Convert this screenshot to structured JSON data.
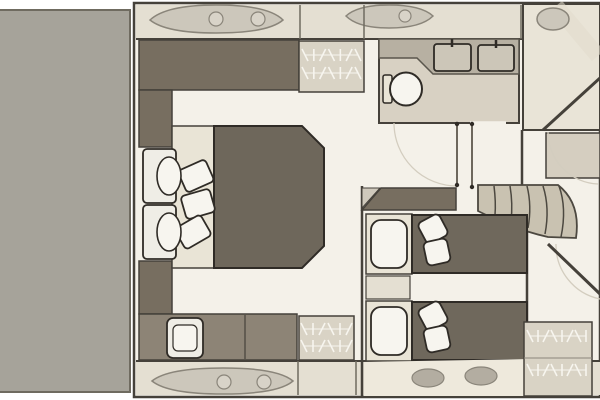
{
  "canvas": {
    "width": 600,
    "height": 400,
    "background": "#ffffff"
  },
  "palette": {
    "garage": "#a6a39a",
    "garageEdge": "#6f6b60",
    "floor": "#f4f1e9",
    "band": "#e4dfd2",
    "bandLight": "#eee9dc",
    "outline": "#45413a",
    "outlineStrong": "#2f2b26",
    "furnDark": "#776e60",
    "bed": "#6e675b",
    "bedTwin": "#6f685c",
    "sofa": "#8d8476",
    "wardrobe": "#d9d3c5",
    "frame": "#e9e4d6",
    "white": "#f7f5ef",
    "white2": "#efede6",
    "bathFloor": "#d8d1c3",
    "counter": "#b7b0a2",
    "counterEdge": "#5a564d",
    "sink": "#ccc6b8",
    "stairs": "#c9c2b1",
    "stairEdge": "#4c4840",
    "hatch": "#ccc7bb",
    "hatch2": "#d8d3c8",
    "hatchEdge": "#8a857a",
    "oval": "#b3ada1",
    "roomLight": "#e9e4d7",
    "bowCab": "#d5cec0",
    "leaf": "#6d675d",
    "faint": "#d3cdbf",
    "sheen": "#e2dccd",
    "wedge": "#cfc9bc"
  },
  "elements": [
    {
      "name": "garage-block",
      "type": "rect",
      "x": -3,
      "y": 10,
      "w": 133,
      "h": 382,
      "fill": "@garage",
      "stroke": "@garageEdge",
      "sw": 2
    },
    {
      "name": "hull-interior-floor",
      "type": "rect",
      "x": 134,
      "y": 3,
      "w": 466,
      "h": 394,
      "fill": "@floor",
      "stroke": "@outline",
      "sw": 2.5
    },
    {
      "name": "side-deck-band-top",
      "type": "rect",
      "x": 136,
      "y": 5,
      "w": 464,
      "h": 34,
      "fill": "@band"
    },
    {
      "name": "side-deck-band-bottom",
      "type": "rect",
      "x": 136,
      "y": 361,
      "w": 464,
      "h": 34,
      "fill": "@band"
    },
    {
      "name": "wall-top-inner",
      "type": "line",
      "x1": 136,
      "y1": 39,
      "x2": 600,
      "y2": 39,
      "stroke": "@outline",
      "sw": 2
    },
    {
      "name": "wall-bottom-inner",
      "type": "line",
      "x1": 136,
      "y1": 361,
      "x2": 600,
      "y2": 361,
      "stroke": "@outline",
      "sw": 2
    },
    {
      "name": "deck-hatch-top-large",
      "type": "path",
      "d": "M150,20 Q166,5 216,5 Q268,5 283,20 Q268,33 216,33 Q166,33 150,20 Z",
      "fill": "@hatch",
      "stroke": "@hatchEdge",
      "sw": 1.5
    },
    {
      "name": "deck-hatch-top-circle-1",
      "type": "ellipse",
      "cx": 216,
      "cy": 19,
      "rx": 7,
      "ry": 7,
      "fill": "@hatch2",
      "stroke": "@hatchEdge",
      "sw": 1.2
    },
    {
      "name": "deck-hatch-top-circle-2",
      "type": "ellipse",
      "cx": 258,
      "cy": 19,
      "rx": 7,
      "ry": 7,
      "fill": "@hatch2",
      "stroke": "@hatchEdge",
      "sw": 1.2
    },
    {
      "name": "deck-hatch-top-small",
      "type": "path",
      "d": "M346,16 Q358,5 389,5 Q421,5 433,16 Q421,28 389,28 Q358,28 346,16 Z",
      "fill": "@hatch",
      "stroke": "@hatchEdge",
      "sw": 1.5
    },
    {
      "name": "deck-hatch-top-small-circle",
      "type": "ellipse",
      "cx": 405,
      "cy": 16,
      "rx": 6,
      "ry": 6,
      "fill": "@hatch2",
      "stroke": "@hatchEdge",
      "sw": 1.2
    },
    {
      "name": "deck-hatch-bottom-large",
      "type": "path",
      "d": "M152,381 Q168,368 223,368 Q278,368 293,381 Q278,394 223,394 Q168,394 152,381 Z",
      "fill": "@hatch",
      "stroke": "@hatchEdge",
      "sw": 1.5
    },
    {
      "name": "deck-hatch-bottom-circle-1",
      "type": "ellipse",
      "cx": 224,
      "cy": 382,
      "rx": 7,
      "ry": 7,
      "fill": "@hatch2",
      "stroke": "@hatchEdge",
      "sw": 1.2
    },
    {
      "name": "deck-hatch-bottom-circle-2",
      "type": "ellipse",
      "cx": 264,
      "cy": 382,
      "rx": 7,
      "ry": 7,
      "fill": "@hatch2",
      "stroke": "@hatchEdge",
      "sw": 1.2
    },
    {
      "name": "wall-column-a",
      "type": "line",
      "x1": 300,
      "y1": 5,
      "x2": 300,
      "y2": 39,
      "stroke": "@garageEdge",
      "sw": 1.5
    },
    {
      "name": "wall-column-b",
      "type": "line",
      "x1": 364,
      "y1": 5,
      "x2": 364,
      "y2": 39,
      "stroke": "@garageEdge",
      "sw": 1.5
    },
    {
      "name": "wall-column-c",
      "type": "line",
      "x1": 521,
      "y1": 5,
      "x2": 521,
      "y2": 39,
      "stroke": "@garageEdge",
      "sw": 1.5
    },
    {
      "name": "wall-column-d",
      "type": "line",
      "x1": 298,
      "y1": 361,
      "x2": 298,
      "y2": 395,
      "stroke": "@garageEdge",
      "sw": 1.5
    },
    {
      "name": "wall-column-e",
      "type": "line",
      "x1": 356,
      "y1": 361,
      "x2": 356,
      "y2": 395,
      "stroke": "@garageEdge",
      "sw": 1.5
    },
    {
      "name": "master-top-cabinet",
      "type": "rect",
      "x": 139,
      "y": 40,
      "w": 160,
      "h": 50,
      "fill": "@furnDark",
      "stroke": "@outline",
      "sw": 1.5
    },
    {
      "name": "master-wardrobe-top",
      "type": "rect",
      "x": 299,
      "y": 41,
      "w": 65,
      "h": 51,
      "fill": "@wardrobe",
      "stroke": "@outline",
      "sw": 1.5
    },
    {
      "name": "hanger-rail-top-wardrobe",
      "type": "hangers",
      "x": 305,
      "y": 49,
      "w": 53,
      "rows": 2,
      "gap": 18,
      "n": 7
    },
    {
      "name": "master-left-cabinet-upper",
      "type": "rect",
      "x": 139,
      "y": 90,
      "w": 33,
      "h": 57,
      "fill": "@furnDark",
      "stroke": "@outline",
      "sw": 1.5
    },
    {
      "name": "master-left-cabinet-lower",
      "type": "rect",
      "x": 139,
      "y": 261,
      "w": 33,
      "h": 53,
      "fill": "@furnDark",
      "stroke": "@outline",
      "sw": 1.5
    },
    {
      "name": "master-bed-headboard",
      "type": "rect",
      "x": 172,
      "y": 126,
      "w": 42,
      "h": 142,
      "fill": "@frame",
      "stroke": "@outline",
      "sw": 1.5
    },
    {
      "name": "master-bed",
      "type": "path",
      "d": "M214,126 L302,126 L324,148 L324,246 L302,268 L214,268 Z",
      "fill": "@bed",
      "stroke": "@outlineStrong",
      "sw": 2
    },
    {
      "name": "master-pillow-1",
      "type": "rect",
      "x": 181,
      "y": 164,
      "w": 30,
      "h": 24,
      "rx": 4,
      "fill": "@white",
      "stroke": "@outlineStrong",
      "sw": 1.8,
      "transform": "rotate(-24 196 176)"
    },
    {
      "name": "master-pillow-2",
      "type": "rect",
      "x": 183,
      "y": 192,
      "w": 30,
      "h": 24,
      "rx": 4,
      "fill": "@white",
      "stroke": "@outlineStrong",
      "sw": 1.8,
      "transform": "rotate(-16 198 204)"
    },
    {
      "name": "master-pillow-3",
      "type": "rect",
      "x": 178,
      "y": 220,
      "w": 30,
      "h": 24,
      "rx": 4,
      "fill": "@white",
      "stroke": "@outlineStrong",
      "sw": 1.8,
      "transform": "rotate(-30 193 232)"
    },
    {
      "name": "armchair-1-back",
      "type": "rect",
      "x": 143,
      "y": 149,
      "w": 33,
      "h": 54,
      "rx": 4,
      "fill": "@white2",
      "stroke": "@outlineStrong",
      "sw": 1.8
    },
    {
      "name": "armchair-1-cushion",
      "type": "ellipse",
      "cx": 169,
      "cy": 176,
      "rx": 12,
      "ry": 19,
      "fill": "@white",
      "stroke": "@outlineStrong",
      "sw": 1.6
    },
    {
      "name": "armchair-2-back",
      "type": "rect",
      "x": 143,
      "y": 205,
      "w": 33,
      "h": 54,
      "rx": 4,
      "fill": "@white2",
      "stroke": "@outlineStrong",
      "sw": 1.8
    },
    {
      "name": "armchair-2-cushion",
      "type": "ellipse",
      "cx": 169,
      "cy": 232,
      "rx": 12,
      "ry": 19,
      "fill": "@white",
      "stroke": "@outlineStrong",
      "sw": 1.6
    },
    {
      "name": "master-sofa",
      "type": "rect",
      "x": 139,
      "y": 314,
      "w": 158,
      "h": 46,
      "fill": "@sofa",
      "stroke": "@outline",
      "sw": 1.5
    },
    {
      "name": "master-sofa-divider",
      "type": "line",
      "x1": 245,
      "y1": 315,
      "x2": 245,
      "y2": 359,
      "stroke": "@outline",
      "sw": 1.2
    },
    {
      "name": "master-sofa-seat",
      "type": "rect",
      "x": 167,
      "y": 318,
      "w": 36,
      "h": 40,
      "rx": 6,
      "fill": "@white2",
      "stroke": "@outlineStrong",
      "sw": 1.8
    },
    {
      "name": "master-sofa-seat-inner",
      "type": "rect",
      "x": 173,
      "y": 325,
      "w": 24,
      "h": 26,
      "rx": 5,
      "fill": "@white",
      "stroke": "@outlineStrong",
      "sw": 1.2
    },
    {
      "name": "master-wardrobe-bottom",
      "type": "rect",
      "x": 299,
      "y": 316,
      "w": 55,
      "h": 44,
      "fill": "@wardrobe",
      "stroke": "@outline",
      "sw": 1.5
    },
    {
      "name": "hanger-rail-bottom-wardrobe",
      "type": "hangers",
      "x": 304,
      "y": 323,
      "w": 45,
      "rows": 2,
      "gap": 17,
      "n": 6
    },
    {
      "name": "bathroom-floor",
      "type": "rect",
      "x": 379,
      "y": 39,
      "w": 140,
      "h": 84,
      "fill": "@bathFloor",
      "stroke": "@outline",
      "sw": 2
    },
    {
      "name": "bathroom-counter",
      "type": "path",
      "d": "M379,39 L519,39 L519,74 L433,74 L417,58 L379,58 Z",
      "fill": "@counter",
      "stroke": "@counterEdge",
      "sw": 1.5
    },
    {
      "name": "sink-1",
      "type": "rect",
      "x": 434,
      "y": 44,
      "w": 37,
      "h": 27,
      "rx": 3,
      "fill": "@sink",
      "stroke": "@outlineStrong",
      "sw": 1.8
    },
    {
      "name": "sink-1-faucet",
      "type": "line",
      "x1": 452,
      "y1": 39,
      "x2": 452,
      "y2": 47,
      "stroke": "@outlineStrong",
      "sw": 2.5
    },
    {
      "name": "sink-2",
      "type": "rect",
      "x": 478,
      "y": 45,
      "w": 36,
      "h": 26,
      "rx": 3,
      "fill": "@sink",
      "stroke": "@outlineStrong",
      "sw": 1.8
    },
    {
      "name": "sink-2-faucet",
      "type": "line",
      "x1": 496,
      "y1": 40,
      "x2": 496,
      "y2": 48,
      "stroke": "@outlineStrong",
      "sw": 2.5
    },
    {
      "name": "toilet-tank",
      "type": "rect",
      "x": 383,
      "y": 75,
      "w": 9,
      "h": 28,
      "rx": 2,
      "fill": "@frame",
      "stroke": "@outlineStrong",
      "sw": 1.5
    },
    {
      "name": "toilet-bowl",
      "type": "ellipse",
      "cx": 406,
      "cy": 89,
      "rx": 16,
      "ry": 16.5,
      "fill": "@white",
      "stroke": "@outlineStrong",
      "sw": 2
    },
    {
      "name": "bathroom-door-gap",
      "type": "line",
      "x1": 470,
      "y1": 123,
      "x2": 506,
      "y2": 123,
      "stroke": "@floor",
      "sw": 3.5
    },
    {
      "name": "shower-room",
      "type": "rect",
      "x": 523,
      "y": 4,
      "w": 77,
      "h": 126,
      "fill": "@roomLight",
      "stroke": "@outline",
      "sw": 2
    },
    {
      "name": "shower-sheen",
      "type": "line",
      "x1": 556,
      "y1": 6,
      "x2": 598,
      "y2": 56,
      "stroke": "@sheen",
      "sw": 16,
      "op": 0.55
    },
    {
      "name": "shower-hatch",
      "type": "ellipse",
      "cx": 553,
      "cy": 19,
      "rx": 16,
      "ry": 11,
      "fill": "@hatch",
      "stroke": "@hatchEdge",
      "sw": 1.5
    },
    {
      "name": "bow-wall-upper",
      "type": "line",
      "x1": 543,
      "y1": 130,
      "x2": 600,
      "y2": 78,
      "stroke": "@outline",
      "sw": 3
    },
    {
      "name": "bow-cabinet",
      "type": "rect",
      "x": 546,
      "y": 133,
      "w": 54,
      "h": 45,
      "fill": "@bowCab",
      "stroke": "@outline",
      "sw": 1.5
    },
    {
      "name": "door-swing-arc-bathroom",
      "type": "path",
      "d": "M457,186 A63,63 0 0 1 394,123",
      "stroke": "@faint",
      "sw": 1.3
    },
    {
      "name": "door-swing-arc-bow-upper",
      "type": "path",
      "d": "M548,132 A52,52 0 0 0 598,184",
      "stroke": "@faint",
      "sw": 1.3
    },
    {
      "name": "door-swing-arc-bow-lower",
      "type": "path",
      "d": "M556,244 A55,55 0 0 0 600,299",
      "stroke": "@faint",
      "sw": 1.3
    },
    {
      "name": "door-leaf-1",
      "type": "line",
      "x1": 457,
      "y1": 123,
      "x2": 457,
      "y2": 186,
      "stroke": "@leaf",
      "sw": 2
    },
    {
      "name": "door-leaf-2",
      "type": "line",
      "x1": 472,
      "y1": 123,
      "x2": 472,
      "y2": 186,
      "stroke": "@leaf",
      "sw": 2
    },
    {
      "name": "door-hinge-dots",
      "type": "dots",
      "r": 2.2,
      "fill": "@outlineStrong",
      "pts": [
        [
          457,
          124
        ],
        [
          457,
          185
        ],
        [
          472,
          124
        ],
        [
          472,
          187
        ]
      ]
    },
    {
      "name": "bow-wall-lower",
      "type": "line",
      "x1": 548,
      "y1": 244,
      "x2": 600,
      "y2": 294,
      "stroke": "@outline",
      "sw": 3
    },
    {
      "name": "bow-wall-stub",
      "type": "line",
      "x1": 522,
      "y1": 130,
      "x2": 522,
      "y2": 186,
      "stroke": "@outline",
      "sw": 2.5
    },
    {
      "name": "twin-right-wall",
      "type": "line",
      "x1": 527,
      "y1": 212,
      "x2": 527,
      "y2": 332,
      "stroke": "@outline",
      "sw": 2.5
    },
    {
      "name": "twin-left-wall",
      "type": "line",
      "x1": 362,
      "y1": 186,
      "x2": 362,
      "y2": 396,
      "stroke": "@outline",
      "sw": 2.5
    },
    {
      "name": "twin-wall-cap-wedge",
      "type": "path",
      "d": "M362,188 L380,188 L362,208 Z",
      "fill": "@wedge",
      "stroke": "@outline",
      "sw": 1
    },
    {
      "name": "twin-top-cabinet",
      "type": "path",
      "d": "M362,210 L381,188 L456,188 L456,210 Z",
      "fill": "@furnDark",
      "stroke": "@outline",
      "sw": 1.5
    },
    {
      "name": "staircase-base",
      "type": "path",
      "d": "M478,185 L558,185 Q581,203 576,238 L548,237 Q516,230 478,211 Z",
      "fill": "@stairs",
      "stroke": "@stairEdge",
      "sw": 1.8
    },
    {
      "name": "stair-tread-1",
      "type": "path",
      "d": "M494,186 Q496,202 495,215",
      "stroke": "@stairEdge",
      "sw": 1.5
    },
    {
      "name": "stair-tread-2",
      "type": "path",
      "d": "M510,186 Q513,204 511,221",
      "stroke": "@stairEdge",
      "sw": 1.5
    },
    {
      "name": "stair-tread-3",
      "type": "path",
      "d": "M527,186 Q532,206 528,228",
      "stroke": "@stairEdge",
      "sw": 1.5
    },
    {
      "name": "stair-tread-4",
      "type": "path",
      "d": "M543,186 Q550,208 545,234",
      "stroke": "@stairEdge",
      "sw": 1.5
    },
    {
      "name": "stair-tread-5",
      "type": "path",
      "d": "M559,186 Q567,208 561,237",
      "stroke": "@stairEdge",
      "sw": 1.5
    },
    {
      "name": "twin-bed-1-frame",
      "type": "rect",
      "x": 366,
      "y": 214,
      "w": 46,
      "h": 60,
      "fill": "@frame",
      "stroke": "@outline",
      "sw": 1.5
    },
    {
      "name": "twin-bed-1-pillow",
      "type": "rect",
      "x": 371,
      "y": 220,
      "w": 36,
      "h": 48,
      "rx": 10,
      "fill": "@white",
      "stroke": "@outlineStrong",
      "sw": 1.8
    },
    {
      "name": "twin-bed-1-mattress",
      "type": "rect",
      "x": 412,
      "y": 215,
      "w": 115,
      "h": 58,
      "fill": "@bedTwin",
      "stroke": "@outlineStrong",
      "sw": 2
    },
    {
      "name": "twin-bed-1-cushion-1",
      "type": "rect",
      "x": 421,
      "y": 217,
      "w": 24,
      "h": 24,
      "rx": 5,
      "fill": "@white",
      "stroke": "@outlineStrong",
      "sw": 1.8,
      "transform": "rotate(-28 433 229)"
    },
    {
      "name": "twin-bed-1-cushion-2",
      "type": "rect",
      "x": 425,
      "y": 240,
      "w": 24,
      "h": 24,
      "rx": 5,
      "fill": "@white",
      "stroke": "@outlineStrong",
      "sw": 1.8,
      "transform": "rotate(-12 437 252)"
    },
    {
      "name": "twin-nightstand",
      "type": "rect",
      "x": 366,
      "y": 276,
      "w": 44,
      "h": 23,
      "fill": "@band",
      "stroke": "@outline",
      "sw": 1.2
    },
    {
      "name": "twin-bed-2-frame",
      "type": "rect",
      "x": 366,
      "y": 301,
      "w": 46,
      "h": 60,
      "fill": "@frame",
      "stroke": "@outline",
      "sw": 1.5
    },
    {
      "name": "twin-bed-2-pillow",
      "type": "rect",
      "x": 371,
      "y": 307,
      "w": 36,
      "h": 48,
      "rx": 10,
      "fill": "@white",
      "stroke": "@outlineStrong",
      "sw": 1.8
    },
    {
      "name": "twin-bed-2-mattress",
      "type": "rect",
      "x": 412,
      "y": 302,
      "w": 115,
      "h": 58,
      "fill": "@bedTwin",
      "stroke": "@outlineStrong",
      "sw": 2
    },
    {
      "name": "twin-bed-2-cushion-1",
      "type": "rect",
      "x": 421,
      "y": 304,
      "w": 24,
      "h": 24,
      "rx": 5,
      "fill": "@white",
      "stroke": "@outlineStrong",
      "sw": 1.8,
      "transform": "rotate(-28 433 316)"
    },
    {
      "name": "twin-bed-2-cushion-2",
      "type": "rect",
      "x": 425,
      "y": 327,
      "w": 24,
      "h": 24,
      "rx": 5,
      "fill": "@white",
      "stroke": "@outlineStrong",
      "sw": 1.8,
      "transform": "rotate(-12 437 339)"
    },
    {
      "name": "twin-hull-band",
      "type": "path",
      "d": "M364,362 L527,359 L527,396 L364,396 Z",
      "fill": "@bandLight"
    },
    {
      "name": "porthole-1",
      "type": "ellipse",
      "cx": 428,
      "cy": 378,
      "rx": 16,
      "ry": 9,
      "fill": "@oval",
      "stroke": "@hatchEdge",
      "sw": 1.2
    },
    {
      "name": "porthole-2",
      "type": "ellipse",
      "cx": 481,
      "cy": 376,
      "rx": 16,
      "ry": 9,
      "fill": "@oval",
      "stroke": "@hatchEdge",
      "sw": 1.2
    },
    {
      "name": "bow-wardrobe",
      "type": "rect",
      "x": 524,
      "y": 322,
      "w": 68,
      "h": 74,
      "fill": "@wardrobe",
      "stroke": "@outline",
      "sw": 1.5
    },
    {
      "name": "bow-wardrobe-shelf",
      "type": "line",
      "x1": 524,
      "y1": 358,
      "x2": 592,
      "y2": 358,
      "stroke": "@hatchEdge",
      "sw": 1
    },
    {
      "name": "hanger-rail-bow-wardrobe",
      "type": "hangers",
      "x": 530,
      "y": 330,
      "w": 56,
      "rows": 2,
      "gap": 34,
      "n": 8
    }
  ]
}
